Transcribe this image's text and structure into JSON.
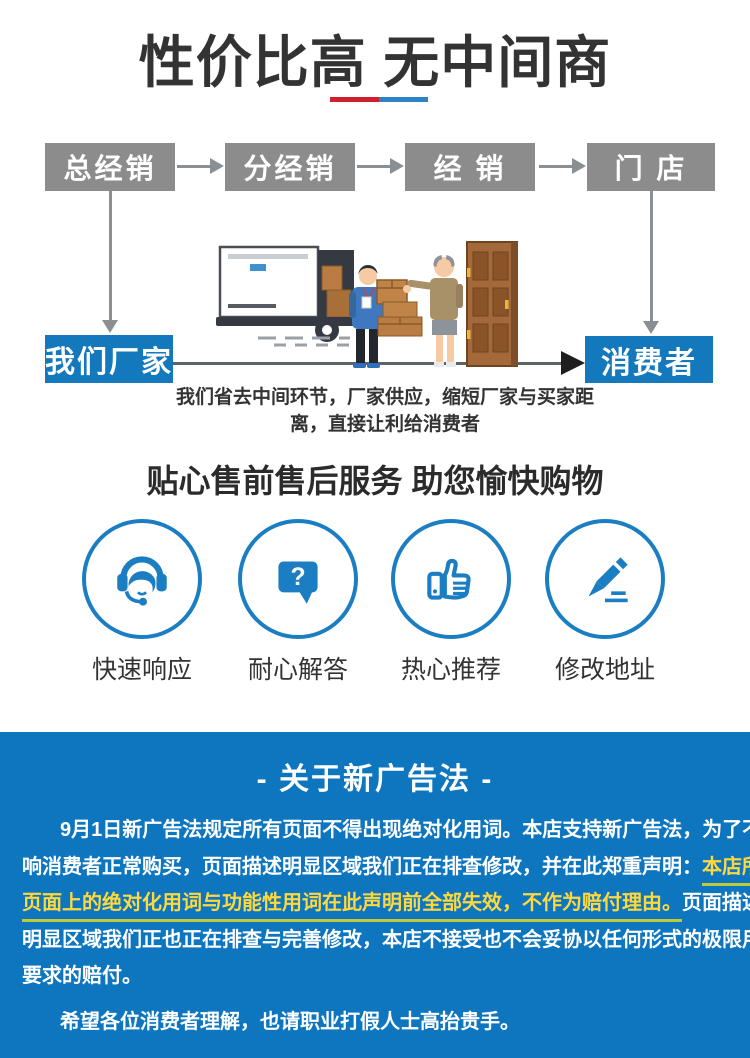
{
  "header": {
    "title": "性价比高 无中间商",
    "underline_red": "#d0202e",
    "underline_blue": "#2e83c2"
  },
  "flow": {
    "levels": [
      "总经销",
      "分经销",
      "经 销",
      "门 店"
    ],
    "factory": "我们厂家",
    "consumer": "消费者",
    "caption_line1": "我们省去中间环节，厂家供应，缩短厂家与买家距",
    "caption_line2": "离，直接让利给消费者",
    "box_gray": "#8c8c8c",
    "box_blue": "#1478bd"
  },
  "services": {
    "title": "贴心售前售后服务 助您愉快购物",
    "accent": "#1b7ec2",
    "items": [
      {
        "icon": "headset-icon",
        "label": "快速响应"
      },
      {
        "icon": "question-bubble-icon",
        "label": "耐心解答"
      },
      {
        "icon": "thumbs-up-icon",
        "label": "热心推荐"
      },
      {
        "icon": "pencil-icon",
        "label": "修改地址"
      }
    ]
  },
  "disclaimer": {
    "title": "- 关于新广告法 -",
    "bg": "#0e76be",
    "highlight_color": "#ffd83e",
    "lines": {
      "l1": "9月1日新广告法规定所有页面不得出现绝对化用词。本店支持新广告法，为了不影",
      "l2_white": "响消费者正常购买，页面描述明显区域我们正在排查修改，并在此郑重声明：",
      "l2_yellow": "本店所有",
      "l3_yellow": "页面上的绝对化用词与功能性用词在此声明前全部失效，不作为赔付理由。",
      "l3_white": "页面描述不",
      "l4": "明显区域我们正也正在排查与完善修改，本店不接受也不会妥协以任何形式的极限用词",
      "l5": "要求的赔付。",
      "l6": "希望各位消费者理解，也请职业打假人士高抬贵手。"
    }
  }
}
